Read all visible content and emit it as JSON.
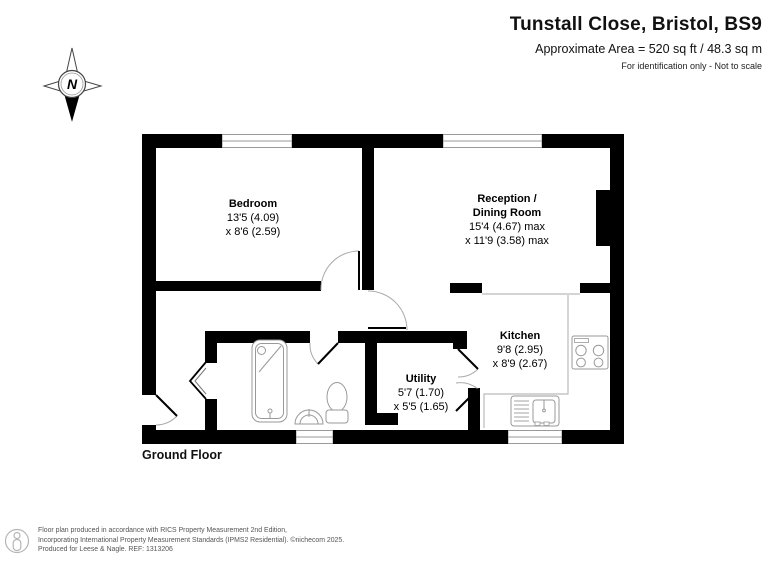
{
  "header": {
    "title": "Tunstall Close, Bristol, BS9",
    "area_line": "Approximate Area = 520 sq ft / 48.3 sq m",
    "disclaimer": "For identification only - Not to scale"
  },
  "compass": {
    "north_label": "N"
  },
  "floor_label": "Ground Floor",
  "rooms": {
    "bedroom": {
      "name": "Bedroom",
      "dim1": "13'5 (4.09)",
      "dim2": "x 8'6 (2.59)"
    },
    "reception": {
      "name_line1": "Reception /",
      "name_line2": "Dining Room",
      "dim1": "15'4 (4.67) max",
      "dim2": "x 11'9 (3.58) max"
    },
    "kitchen": {
      "name": "Kitchen",
      "dim1": "9'8 (2.95)",
      "dim2": "x 8'9 (2.67)"
    },
    "utility": {
      "name": "Utility",
      "dim1": "5'7 (1.70)",
      "dim2": "x 5'5 (1.65)"
    }
  },
  "footer": {
    "line1": "Floor plan produced in accordance with RICS Property Measurement 2nd Edition,",
    "line2": "Incorporating International Property Measurement Standards (IPMS2 Residential).  ©nichecom 2025.",
    "line3": "Produced for Leese & Nagle.   REF:  1313206"
  },
  "colors": {
    "wall": "#000000",
    "fixture_stroke": "#999999",
    "counter_stroke": "#bbbbbb",
    "window_stroke": "#9a9a9a",
    "arc_stroke": "#aaaaaa",
    "footer_text": "#555555"
  }
}
